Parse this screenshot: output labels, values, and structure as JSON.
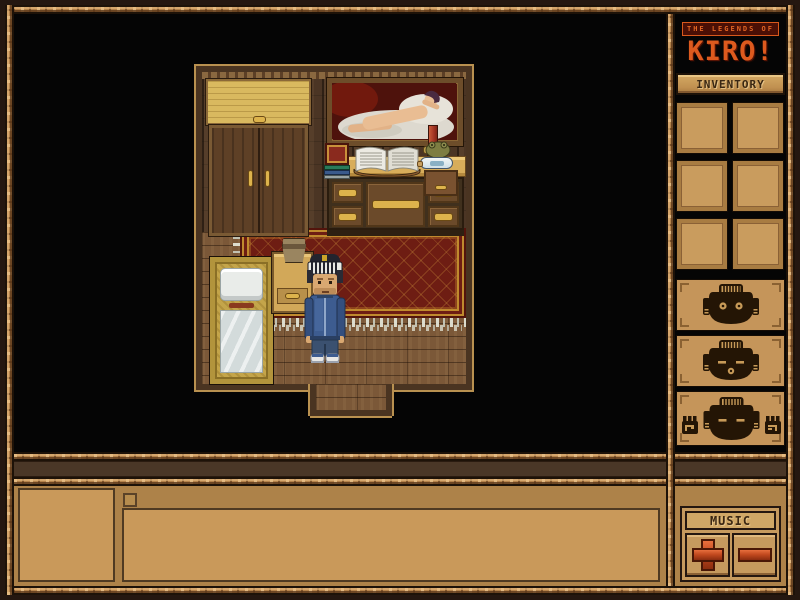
{
  "app": {
    "title_small": "THE LEGENDS OF",
    "title_main": "KIRO!"
  },
  "sidebar": {
    "inventory_label": "INVENTORY",
    "inventory_slots": [
      "empty",
      "empty",
      "empty",
      "empty",
      "empty",
      "empty"
    ],
    "mask_buttons": [
      {
        "icon": "mask-open-eyes-icon"
      },
      {
        "icon": "mask-mouth-icon"
      },
      {
        "icon": "mask-hands-icon"
      }
    ],
    "music": {
      "label": "MUSIC",
      "increase_icon": "plus-icon",
      "decrease_icon": "minus-icon"
    }
  },
  "bottom_bar": {
    "portrait_box": "empty",
    "checkbox_checked": false,
    "message_text": ""
  },
  "scene": {
    "objects": [
      "wardrobe",
      "painting-reclining-figure",
      "desk",
      "book-stack",
      "open-book",
      "candle",
      "figurine",
      "ship-in-bottle",
      "small-drawer-box",
      "potted-fern",
      "nightstand",
      "bed",
      "red-rug",
      "player-character",
      "doorway"
    ]
  },
  "colors": {
    "accent_orange": "#dd5a1e",
    "button_red": "#c2491f",
    "panel_tan": "#c79a5c",
    "rope_tan": "#b5834b",
    "rug_red": "#6e1d13",
    "background_black": "#050505"
  }
}
